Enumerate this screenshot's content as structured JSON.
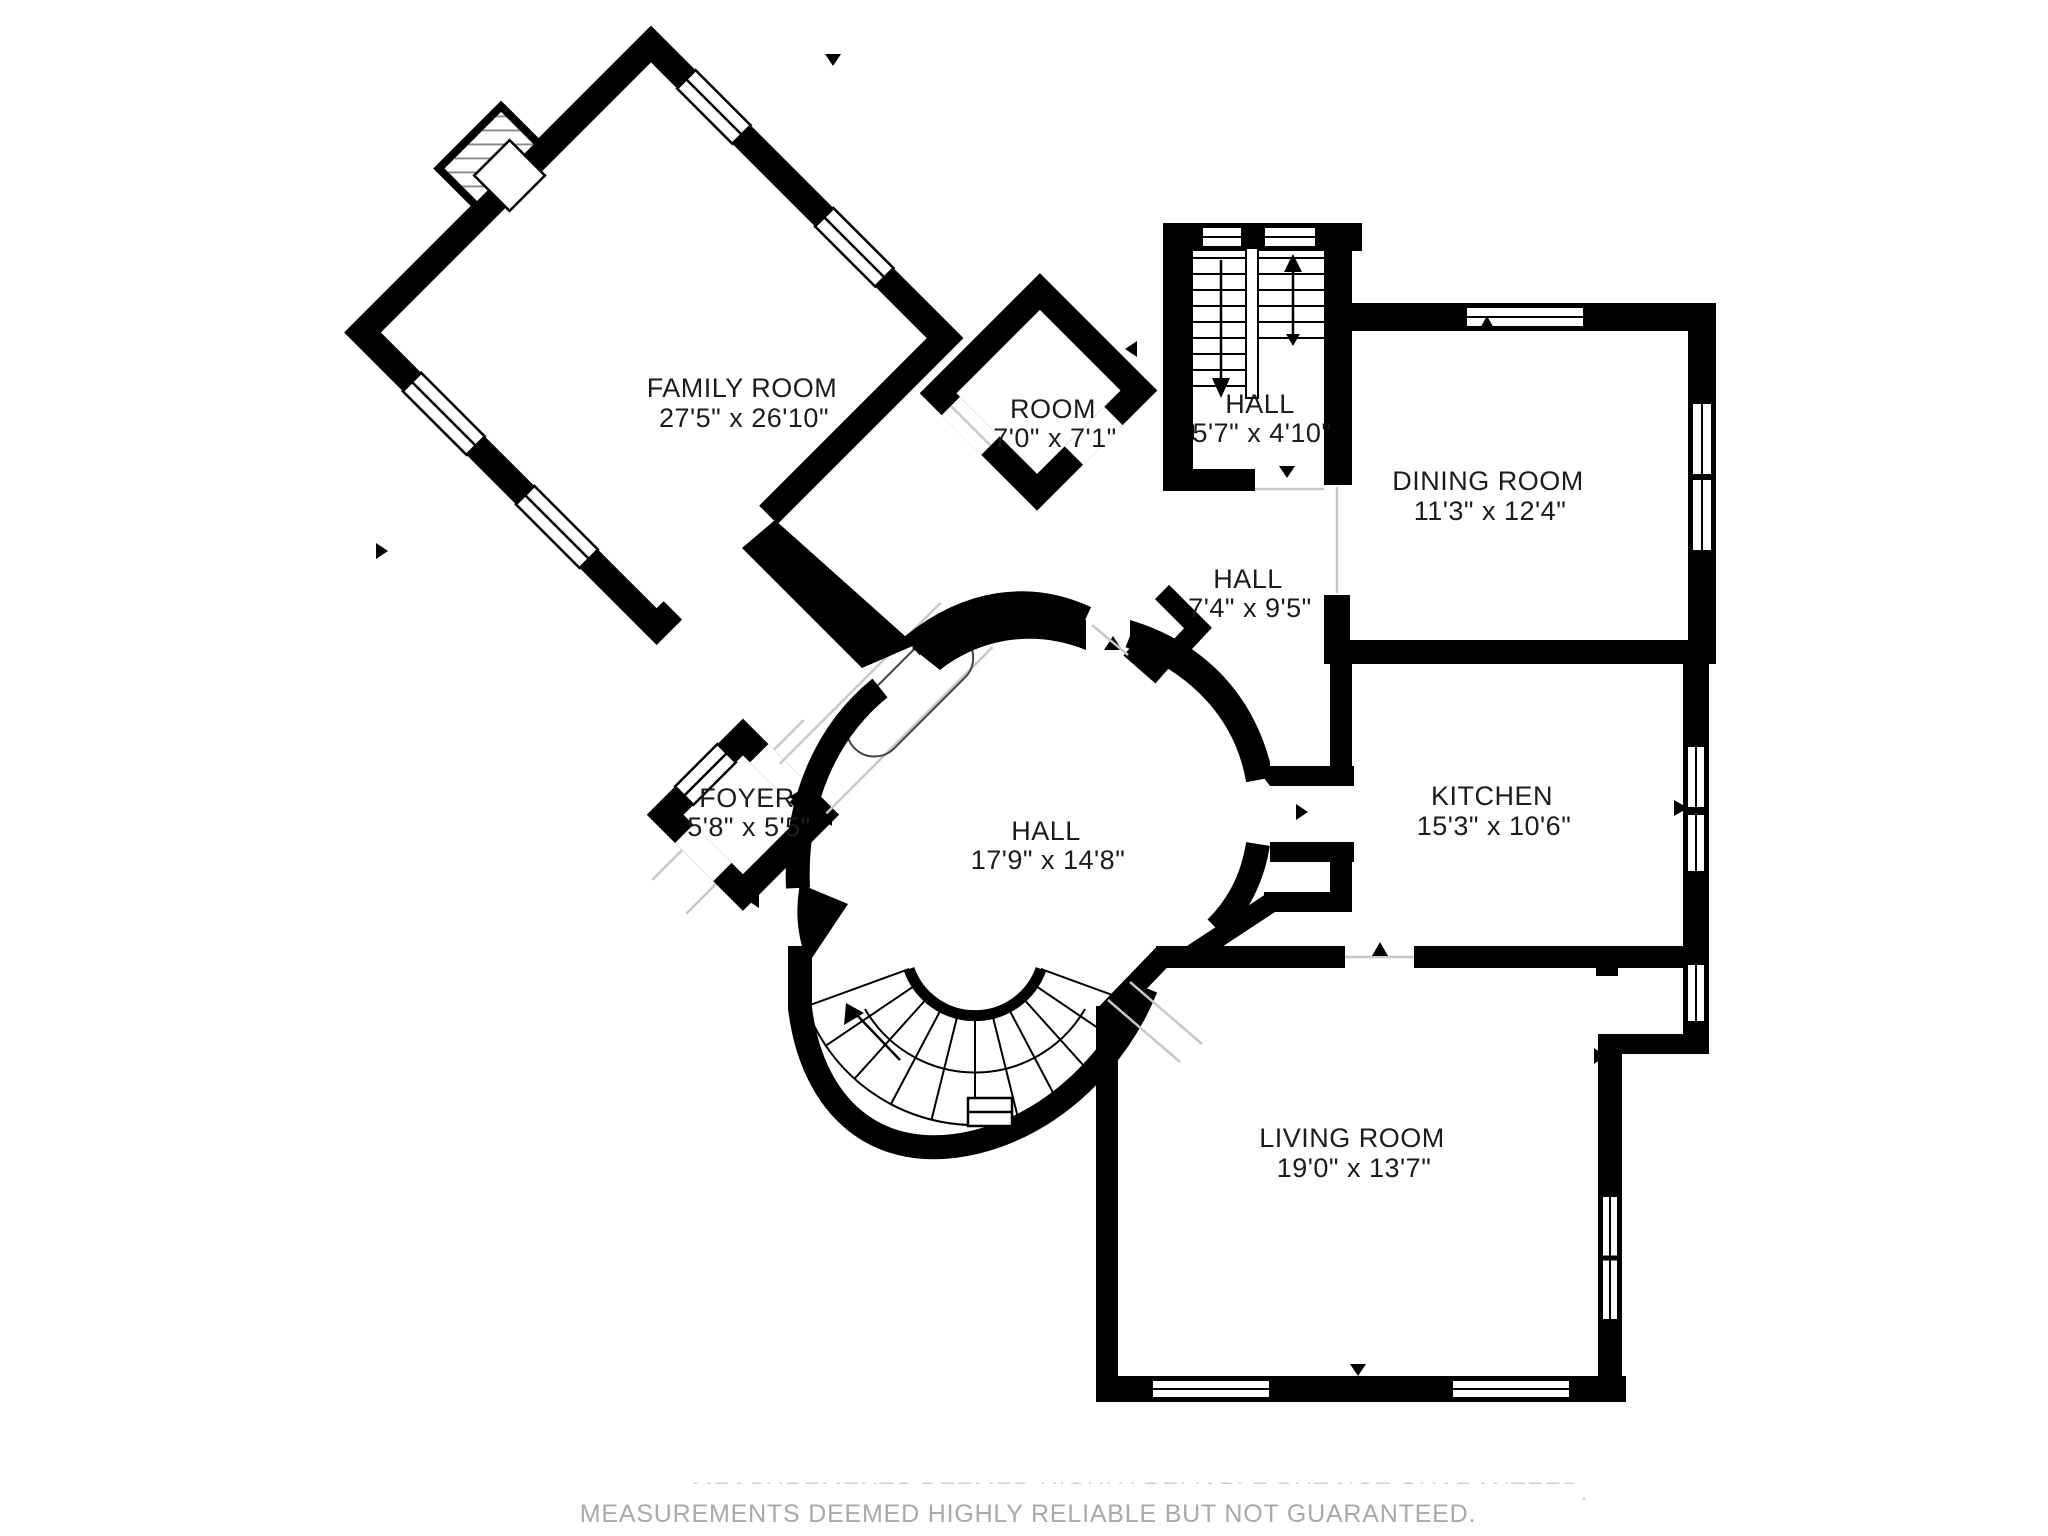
{
  "page": {
    "title": "First floor plan",
    "background": "#ffffff",
    "disclaimer": "MEASUREMENTS DEEMED HIGHLY RELIABLE BUT NOT GUARANTEED.",
    "disclaimer_faint": "MEASUREMENTS DEEMED HIGHLY RELIABLE BUT NOT GUARANTEED.",
    "disclaimer_color": "#a9a9a9"
  },
  "colors": {
    "wall": "#000000",
    "floor": "#ffffff",
    "door_swing_line": "#c8c8c8",
    "label_text": "#1c1c1c"
  },
  "rooms": {
    "family_room": {
      "name": "FAMILY ROOM",
      "dims": "27'5\" x 26'10\""
    },
    "room": {
      "name": "ROOM",
      "dims": "7'0\" x 7'1\""
    },
    "stair_hall": {
      "name": "HALL",
      "dims": "5'7\" x 4'10\""
    },
    "dining_room": {
      "name": "DINING ROOM",
      "dims": "11'3\" x 12'4\""
    },
    "upper_hall": {
      "name": "HALL",
      "dims": "7'4\" x 9'5\""
    },
    "foyer": {
      "name": "FOYER",
      "dims": "5'8\" x 5'5\""
    },
    "central_hall": {
      "name": "HALL",
      "dims": "17'9\" x 14'8\""
    },
    "kitchen": {
      "name": "KITCHEN",
      "dims": "15'3\" x 10'6\""
    },
    "living_room": {
      "name": "LIVING ROOM",
      "dims": "19'0\" x 13'7\""
    }
  },
  "features": {
    "staircase_main": "straight double-run staircase with up and down arrows",
    "staircase_curved": "curved fan staircase in central hall with up arrow",
    "fireplace": "fireplace on family room upper-left wall"
  }
}
